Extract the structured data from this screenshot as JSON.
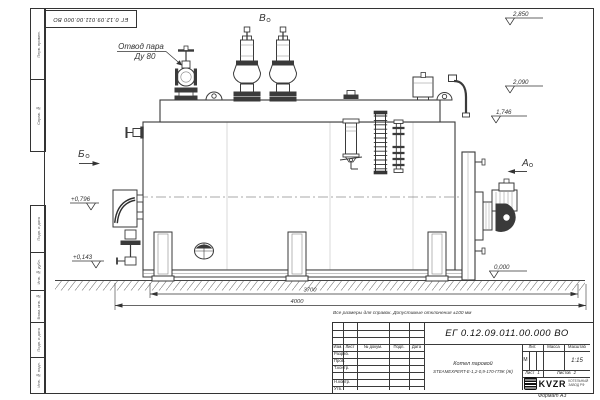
{
  "frame": {
    "stamp": "ЕГ 0.12.09.011.00.000  ВО",
    "format": "Формат А3",
    "border_labels": [
      "Перв. примен.",
      "Справ. №",
      "Подп. и дата",
      "Инв. № дубл.",
      "Взам. инв. №",
      "Подп. и дата",
      "Инв. № подл."
    ]
  },
  "note": "Все размеры для справок. Допустимые отклонения ±100 мм",
  "drawing": {
    "callout": {
      "line1": "Отвод пара",
      "line2": "Ду 80"
    },
    "views": {
      "v": "В",
      "b": "Б",
      "a": "А"
    },
    "elevations": {
      "e2850": "2,850",
      "e2090": "2,090",
      "e1746": "1,746",
      "e0796": "+0,796",
      "e0143": "+0,143",
      "e0000": "0,000"
    },
    "dims": {
      "d1": "3700",
      "d2": "4000"
    }
  },
  "title_block": {
    "designation": "ЕГ 0.12.09.011.00.000  ВО",
    "doc_name_line1": "Котел паровой",
    "doc_name_line2": "STEAMEXPERT-Е-1,2-0,9-170-ГПЖ (Ж)",
    "cols": {
      "izm": "Изм.",
      "list": "Лист",
      "ndoc": "№ докум.",
      "podp": "Подп.",
      "data": "Дата"
    },
    "rows": {
      "razrab": "Разраб.",
      "prov": "Пров.",
      "tkontr": "Т.контр.",
      "nkontr": "Н.контр.",
      "utv": "Утв."
    },
    "lit_header": "Лит.",
    "mass_header": "Масса",
    "scale_header": "Масштаб",
    "lit_value": "М",
    "scale_value": "1:15",
    "sheet_label": "Лист",
    "sheet_value": "1",
    "sheets_label": "Листов",
    "sheets_value": "2",
    "logo": {
      "text": "KVZR",
      "sub1": "КОТЕЛЬНЫЙ",
      "sub2": "ЗАВОД РФ"
    }
  }
}
